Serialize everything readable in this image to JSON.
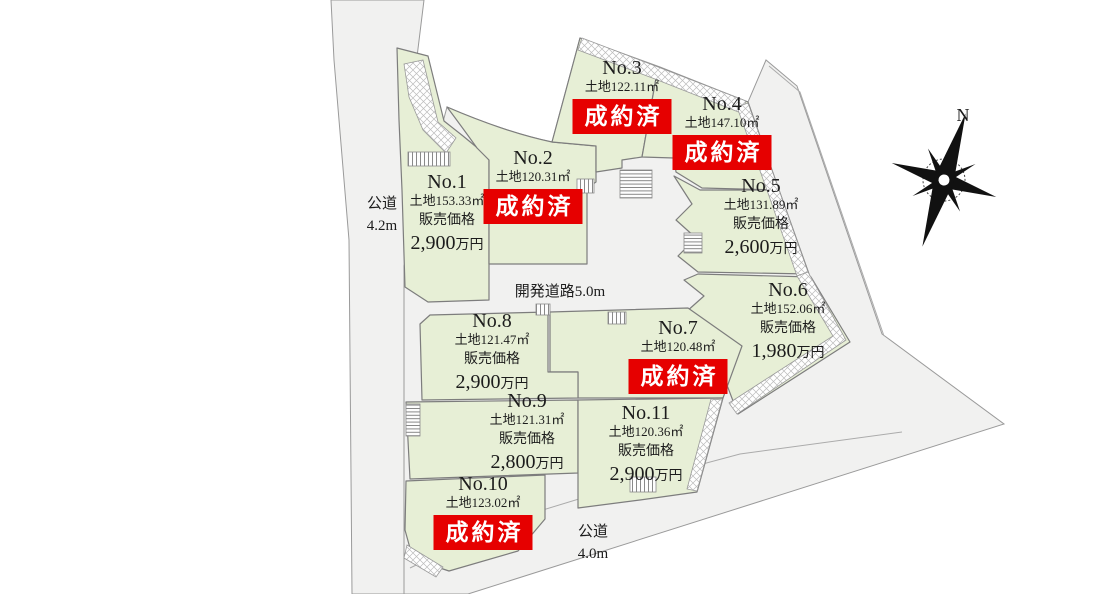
{
  "colors": {
    "lot_green": "#e7efd6",
    "road_gray": "#f1f1f0",
    "sold_red": "#e60000",
    "line_gray": "#8a8a8a"
  },
  "compass": {
    "label": "N"
  },
  "roads": {
    "left": {
      "name": "公道",
      "size": "4.2m"
    },
    "development": {
      "label": "開発道路5.0m"
    },
    "bottom": {
      "name": "公道",
      "size": "4.0m"
    }
  },
  "lots": [
    {
      "no": "No.1",
      "area": "土地153.33㎡",
      "price_label": "販売価格",
      "price": "2,900",
      "price_unit": "万円"
    },
    {
      "no": "No.2",
      "area": "土地120.31㎡",
      "status": "成約済"
    },
    {
      "no": "No.3",
      "area": "土地122.11㎡",
      "status": "成約済"
    },
    {
      "no": "No.4",
      "area": "土地147.10㎡",
      "status": "成約済"
    },
    {
      "no": "No.5",
      "area": "土地131.89㎡",
      "price_label": "販売価格",
      "price": "2,600",
      "price_unit": "万円"
    },
    {
      "no": "No.6",
      "area": "土地152.06㎡",
      "price_label": "販売価格",
      "price": "1,980",
      "price_unit": "万円"
    },
    {
      "no": "No.7",
      "area": "土地120.48㎡",
      "status": "成約済"
    },
    {
      "no": "No.8",
      "area": "土地121.47㎡",
      "price_label": "販売価格",
      "price": "2,900",
      "price_unit": "万円"
    },
    {
      "no": "No.9",
      "area": "土地121.31㎡",
      "price_label": "販売価格",
      "price": "2,800",
      "price_unit": "万円"
    },
    {
      "no": "No.10",
      "area": "土地123.02㎡",
      "status": "成約済"
    },
    {
      "no": "No.11",
      "area": "土地120.36㎡",
      "price_label": "販売価格",
      "price": "2,900",
      "price_unit": "万円"
    }
  ]
}
